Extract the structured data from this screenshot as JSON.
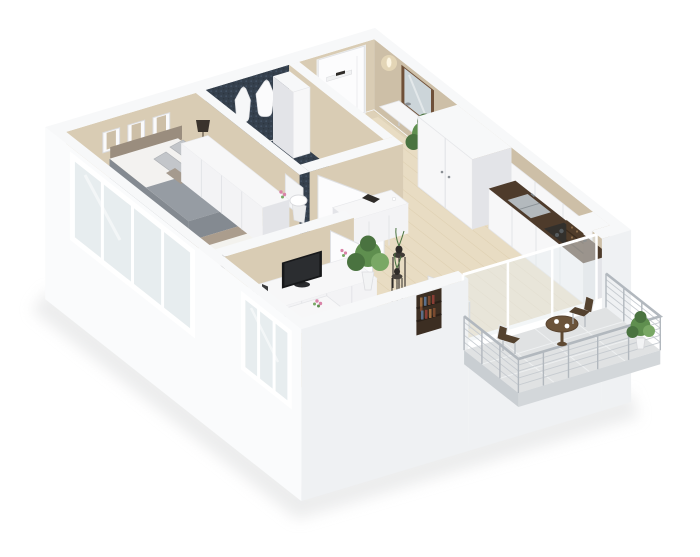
{
  "scene": {
    "type": "3d-floor-plan-render",
    "description": "Isometric cutaway 3D floor plan of a one-bedroom apartment, white exterior walls, beige interior walls, light wood floors, navy mosaic bathroom, balcony with railing",
    "rooms": [
      {
        "name": "bedroom",
        "items": [
          "double-bed",
          "gray-blanket",
          "pillows",
          "white-rug",
          "wall-pictures",
          "bedside-lamp",
          "drum-stool",
          "dresser",
          "laptop-desk",
          "desk-chair"
        ]
      },
      {
        "name": "bathroom",
        "floor": "navy-mosaic",
        "items": [
          "toilet",
          "bathrobes",
          "tall-cabinet",
          "open-door"
        ]
      },
      {
        "name": "entrance-hall",
        "items": [
          "entrance-door",
          "door-shelf",
          "wall-sconce",
          "mirror",
          "console-table",
          "ficus-plant",
          "tall-wardrobe"
        ]
      },
      {
        "name": "kitchen",
        "items": [
          "base-cabinets",
          "dark-countertop",
          "double-sink",
          "cooktop",
          "upper-cabinets",
          "wine-shelf"
        ]
      },
      {
        "name": "living-room",
        "items": [
          "tv",
          "tv-sideboard",
          "decor-console",
          "plant-stands",
          "potted-plant",
          "work-desk",
          "white-chair",
          "bookshelf-niche",
          "dining-table",
          "sliding-glass-doors"
        ]
      },
      {
        "name": "balcony",
        "items": [
          "wire-railing",
          "round-table",
          "coffee-cups",
          "outdoor-chairs",
          "potted-plant",
          "tiled-floor"
        ]
      }
    ],
    "counts": {
      "wall_pictures": 3,
      "bathrobes": 2,
      "balcony_chairs": 2,
      "coffee_cups": 2,
      "windows_front": 2
    }
  },
  "colors": {
    "bg": "#ffffff",
    "walltop": "#f7f8f9",
    "ext1": "#fafbfc",
    "ext2": "#eff1f3",
    "beige1": "#d9ccb4",
    "beige2": "#cdbfa7",
    "wood": "#e8dcc3",
    "wood2": "#d5c4a2",
    "navy": "#35404d",
    "navy2": "#46566a",
    "furniture": "#f7f7f8",
    "furnitureshade": "#e3e4e8",
    "counter": "#4e3b2b",
    "steel": "#b3b9bd",
    "wine": "#503c2a",
    "hob": "#33302c",
    "bedframe": "#ab9d8d",
    "blanket": "#969ca3",
    "blanket2": "#848a91",
    "sheet": "#f3f2f0",
    "pillow1": "#c3c6ca",
    "pillow2": "#a59a8e",
    "rug": "#f3f2ee",
    "tv": "#17181a",
    "tvscreen": "#2b2d30",
    "green1": "#5f8f4f",
    "green2": "#4a7340",
    "green3": "#79a865",
    "pot": "#f2f3f4",
    "mirrorframe": "#6f5038",
    "mirrorglass": "#ccd5d9",
    "door": "#fcfcfd",
    "handle": "#8a8f94",
    "balconyfloor": "#e0e2e3",
    "balconytable": "#6b5339",
    "balconychair": "#54422f",
    "glass": "#e7edef",
    "glassframe": "#ffffff",
    "rail": "#c6cbd0",
    "rail2": "#b2b8be",
    "white": "#fdfdfd",
    "sconce": "#f6e7c2",
    "lampshade": "#3a332c",
    "stool": "#b6a896",
    "darkdecor": "#2e2b28",
    "leg": "#c9ccd0",
    "niche": "#3c2e22",
    "book1": "#7a4a2f",
    "book2": "#9c6b3e",
    "book3": "#5a6f8a",
    "book4": "#8a3e35",
    "shadow": "#dddedf"
  }
}
